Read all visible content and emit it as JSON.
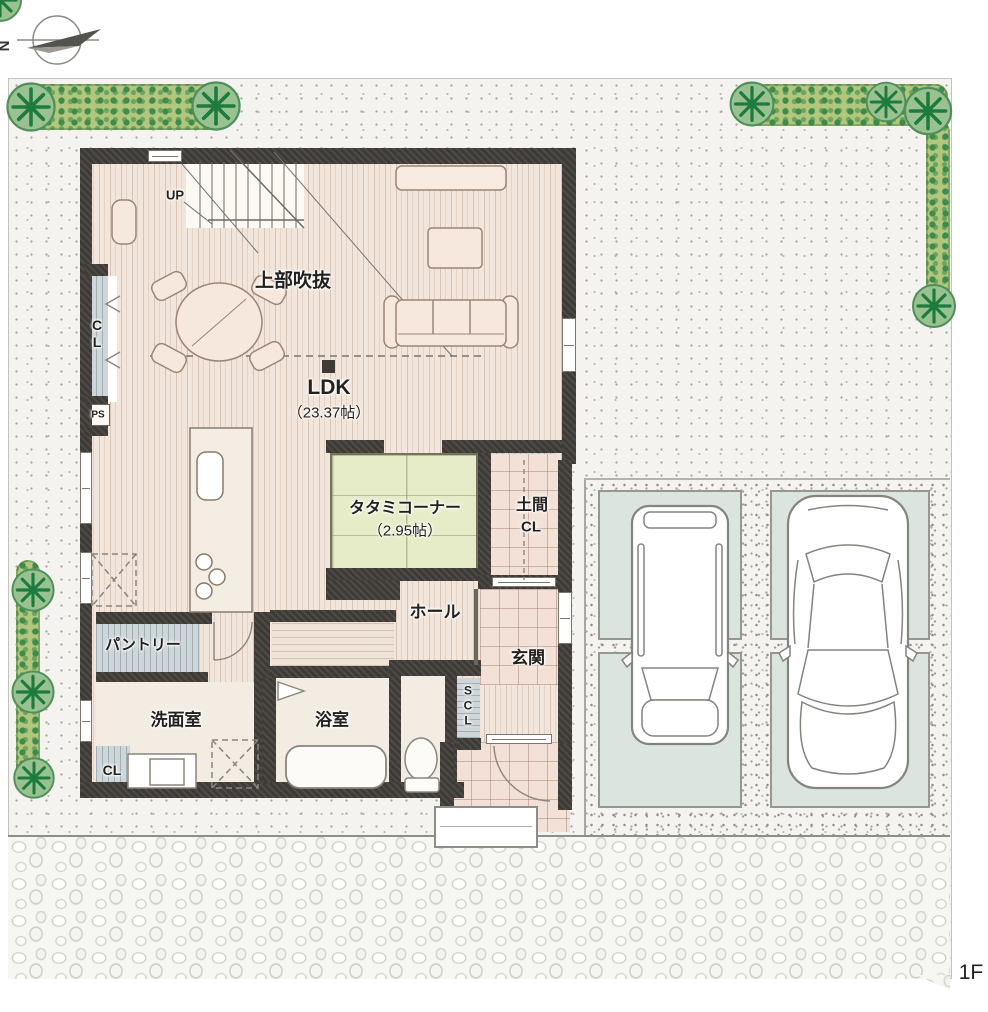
{
  "meta": {
    "floor_tag": "1F",
    "compass_letter": "N"
  },
  "labels": {
    "up": "UP",
    "void_above": "上部吹抜",
    "ldk_name": "LDK",
    "ldk_size": "（23.37帖）",
    "tatami_name": "タタミコーナー",
    "tatami_size": "（2.95帖）",
    "doma_line1": "土間",
    "doma_line2": "CL",
    "hall": "ホール",
    "genkan": "玄関",
    "scl": "SCL",
    "pantry": "パントリー",
    "washroom": "洗面室",
    "bathroom": "浴室",
    "closet_left": "CL",
    "ps": "PS",
    "closet_washroom": "CL"
  },
  "colors": {
    "site": "#f4f3f0",
    "wall": "#3e3b37",
    "wood": "#f2e5db",
    "tile": "#f3e1d7",
    "tatami": "#e7ecc8",
    "closet": "#ced6da",
    "pad": "#dce4e0",
    "ink": "#23211e",
    "hedge_green": "#b2c77d",
    "tree_green": "#1d7b3f",
    "furniture": "#f6e8dd"
  }
}
